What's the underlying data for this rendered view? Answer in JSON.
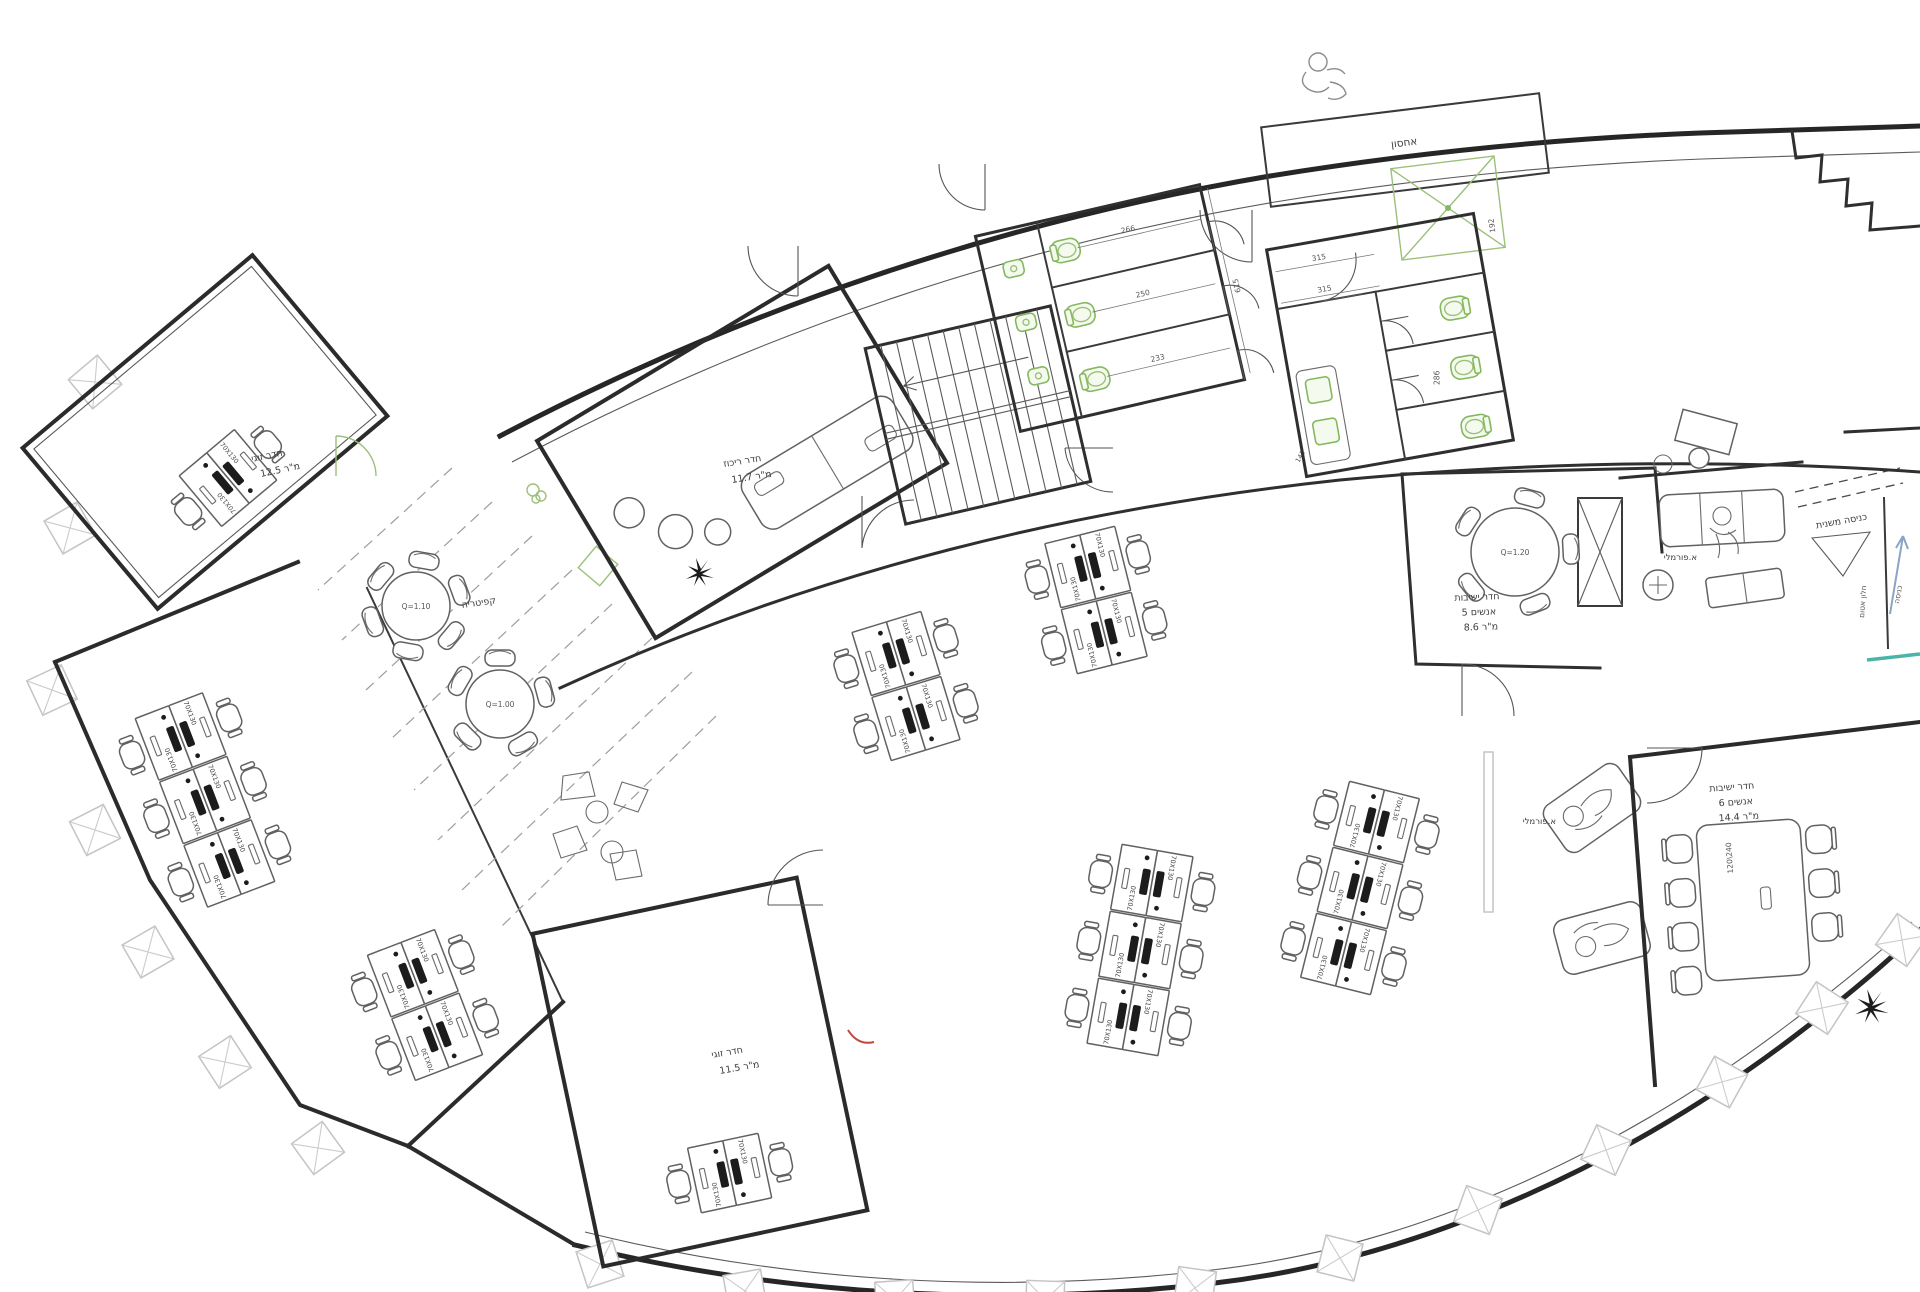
{
  "colors": {
    "wall": "#262626",
    "fixture_green": "#86b85e",
    "column_gray": "#c4c4c4",
    "arrow_blue": "#8aa4c8",
    "glass_teal": "#4ab5a6",
    "accent_red": "#c0473a"
  },
  "rooms": {
    "double_room_top": {
      "name": "חדר זוגי",
      "area": "12.5 מ\"ר"
    },
    "double_room_bottom": {
      "name": "חדר זוגי",
      "area": "11.5 מ\"ר"
    },
    "focus_room": {
      "name": "חדר ריכוז",
      "area": "11.7 מ\"ר"
    },
    "cafeteria": {
      "name": "קפיטריה"
    },
    "storage": {
      "name": "אחסון"
    },
    "meeting_room_5": {
      "name": "חדר ישיבות",
      "capacity": "5 אנשים",
      "area": "8.6 מ\"ר"
    },
    "meeting_room_6": {
      "name": "חדר ישיבות",
      "capacity": "6 אנשים",
      "area": "14.4 מ\"ר"
    },
    "informal_area_1": {
      "name": "א.פורמלי"
    },
    "informal_area_2": {
      "name": "א.פורמלי"
    }
  },
  "annotations": {
    "secondary_entrance": "כניסה משנית",
    "sealed_window": "חלון אטום",
    "entry_arrow": "כניסה"
  },
  "furniture": {
    "desk_size": "70X130",
    "cafeteria_table_1": "Q=1.10",
    "cafeteria_table_2": "Q=1.00",
    "meeting_table_5": "Q=1.20",
    "conference_table": "120\\240"
  },
  "dimensions": {
    "wc_block_1_stalls": [
      "266",
      "250",
      "233"
    ],
    "wc_block_1_depth": "615",
    "wc_block_2_doors": [
      "315",
      "315"
    ],
    "wc_block_2_stall": "286",
    "storage_shaft": "192",
    "door_clearance": "141"
  }
}
